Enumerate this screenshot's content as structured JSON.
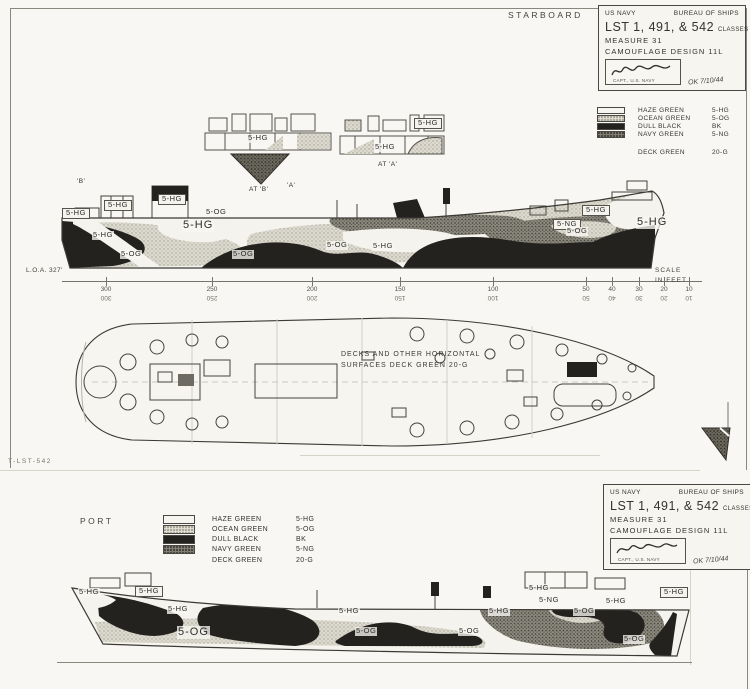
{
  "header": {
    "starboard_label": "STARBOARD",
    "port_label": "PORT"
  },
  "title_block": {
    "agency": "US NAVY",
    "bureau": "BUREAU OF SHIPS",
    "classes_line": "LST 1, 491, & 542",
    "classes_word": "CLASSES",
    "measure_line": "MEASURE 31",
    "design_line": "CAMOUFLAGE DESIGN 11L",
    "approver_title": "CAPT., U.S. NAVY",
    "date_note": "OK 7/10/44"
  },
  "legend": {
    "entries": [
      {
        "name": "HAZE GREEN",
        "code": "5-HG",
        "cls": "sw-haze"
      },
      {
        "name": "OCEAN GREEN",
        "code": "5-OG",
        "cls": "sw-ocean"
      },
      {
        "name": "DULL BLACK",
        "code": "BK",
        "cls": "sw-black"
      },
      {
        "name": "NAVY GREEN",
        "code": "5-NG",
        "cls": "sw-navy"
      }
    ],
    "deck_entry": {
      "name": "DECK GREEN",
      "code": "20-G"
    }
  },
  "colors": {
    "haze_green_swatch": "#f6f5f0",
    "ocean_green_swatch": "#dedbd1",
    "dull_black_swatch": "#23221e",
    "navy_green_swatch": "#807d72",
    "paper": "#f8f7f3",
    "ink": "#34332f"
  },
  "scale": {
    "caption_line1": "SCALE",
    "caption_line2": "IN FEET",
    "ticks": [
      {
        "label": "300",
        "x": 44
      },
      {
        "label": "250",
        "x": 150
      },
      {
        "label": "200",
        "x": 250
      },
      {
        "label": "150",
        "x": 338
      },
      {
        "label": "100",
        "x": 431
      },
      {
        "label": "50",
        "x": 524
      },
      {
        "label": "40",
        "x": 550
      },
      {
        "label": "30",
        "x": 577
      },
      {
        "label": "20",
        "x": 602
      },
      {
        "label": "10",
        "x": 627
      }
    ]
  },
  "dimensions": {
    "loa_label": "L.O.A. 327'"
  },
  "deck_plan": {
    "note_line1": "DECKS AND OTHER HORIZONTAL",
    "note_line2": "SURFACES   DECK GREEN   20-G"
  },
  "sheet": {
    "number": "T-LST-542"
  },
  "upper_labels": [
    {
      "text": "'B'",
      "x": 76,
      "y": 178,
      "cls": "tiny"
    },
    {
      "text": "5-HG",
      "x": 62,
      "y": 208,
      "cls": "boxed"
    },
    {
      "text": "5-HG",
      "x": 104,
      "y": 200,
      "cls": "boxed"
    },
    {
      "text": "5-HG",
      "x": 92,
      "y": 231
    },
    {
      "text": "5-HG",
      "x": 158,
      "y": 194,
      "cls": "boxed"
    },
    {
      "text": "5-OG",
      "x": 205,
      "y": 208
    },
    {
      "text": "5-HG",
      "x": 182,
      "y": 219,
      "cls": "big"
    },
    {
      "text": "5-OG",
      "x": 120,
      "y": 250
    },
    {
      "text": "5-OG",
      "x": 232,
      "y": 250
    },
    {
      "text": "'A'",
      "x": 286,
      "y": 182,
      "cls": "tiny"
    },
    {
      "text": "5-OG",
      "x": 326,
      "y": 241
    },
    {
      "text": "5-HG",
      "x": 372,
      "y": 242
    },
    {
      "text": "5-HG",
      "x": 582,
      "y": 205,
      "cls": "boxed"
    },
    {
      "text": "5-NG",
      "x": 553,
      "y": 219,
      "cls": "boxed"
    },
    {
      "text": "5-OG",
      "x": 566,
      "y": 227
    },
    {
      "text": "5-HG",
      "x": 636,
      "y": 216,
      "cls": "big"
    },
    {
      "text": "5-HG",
      "x": 247,
      "y": 134
    },
    {
      "text": "AT 'B'",
      "x": 248,
      "y": 186,
      "cls": "tiny"
    },
    {
      "text": "5-HG",
      "x": 374,
      "y": 143
    },
    {
      "text": "AT 'A'",
      "x": 377,
      "y": 161,
      "cls": "tiny"
    },
    {
      "text": "5-HG",
      "x": 414,
      "y": 118,
      "cls": "boxed"
    }
  ],
  "lower_labels": [
    {
      "text": "5-HG",
      "x": 78,
      "y": 588
    },
    {
      "text": "5-HG",
      "x": 135,
      "y": 586,
      "cls": "boxed"
    },
    {
      "text": "5-HG",
      "x": 167,
      "y": 605
    },
    {
      "text": "5-OG",
      "x": 177,
      "y": 626,
      "cls": "big"
    },
    {
      "text": "5-HG",
      "x": 338,
      "y": 607
    },
    {
      "text": "5-OG",
      "x": 355,
      "y": 627
    },
    {
      "text": "5-OG",
      "x": 458,
      "y": 627
    },
    {
      "text": "5-HG",
      "x": 488,
      "y": 607
    },
    {
      "text": "5-HG",
      "x": 528,
      "y": 584
    },
    {
      "text": "5-NG",
      "x": 538,
      "y": 596
    },
    {
      "text": "5-OG",
      "x": 573,
      "y": 607
    },
    {
      "text": "5-HG",
      "x": 605,
      "y": 597
    },
    {
      "text": "5-HG",
      "x": 660,
      "y": 587,
      "cls": "boxed"
    },
    {
      "text": "5-OG",
      "x": 623,
      "y": 635
    }
  ]
}
